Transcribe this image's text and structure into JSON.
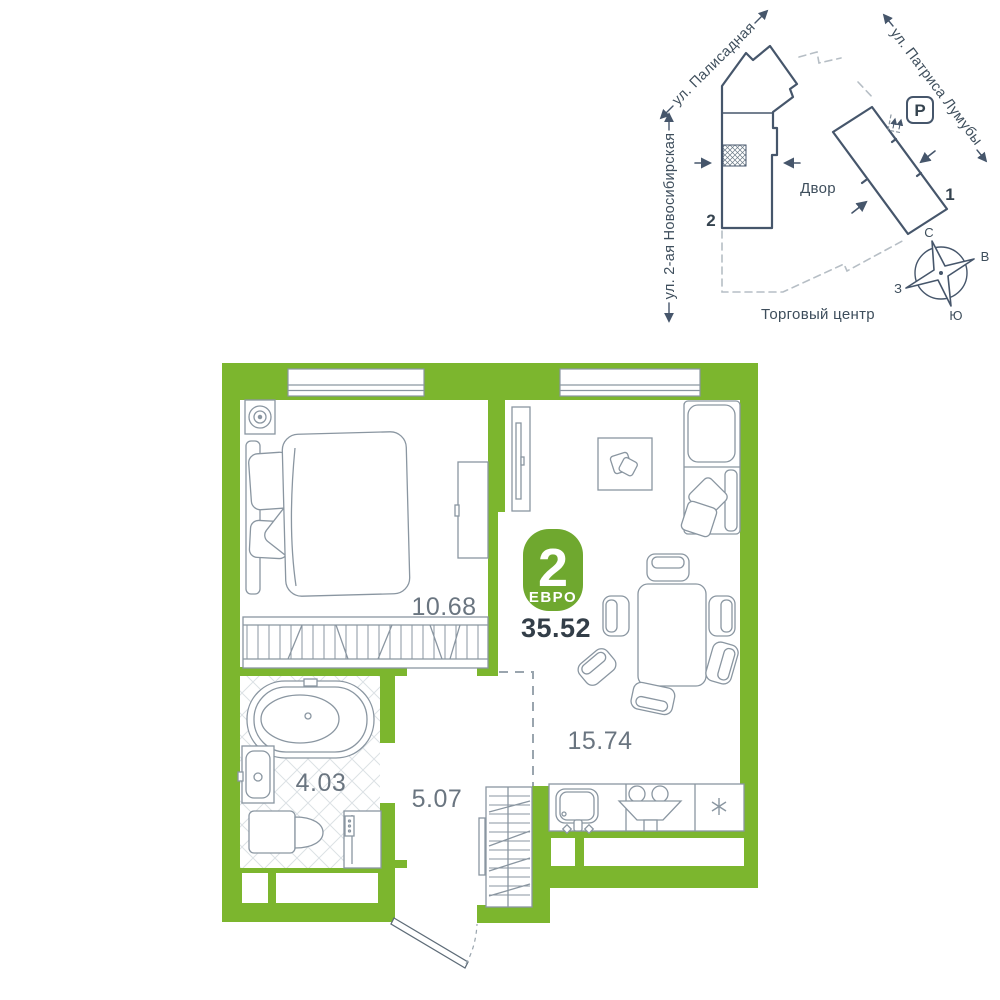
{
  "plan": {
    "badge": {
      "number": "2",
      "type": "ЕВРО"
    },
    "total_area": "35.52",
    "areas": {
      "bedroom": "10.68",
      "living_kitchen": "15.74",
      "bathroom": "4.03",
      "hallway": "5.07"
    }
  },
  "map": {
    "streets": {
      "palisadnaya": "ул. Палисадная",
      "patrisa_lumumby": "ул. Патриса Лумубы",
      "novosibirskaya": "ул. 2-ая Новосибирская"
    },
    "yard_label": "Двор",
    "mall_label": "Торговый центр",
    "parking_label": "P",
    "building_1_label": "1",
    "building_2_label": "2",
    "compass": {
      "north": "С",
      "east": "В",
      "south": "Ю",
      "west": "З"
    }
  },
  "colors": {
    "wall_green": "#7CB62E",
    "badge_green": "#6FA82F",
    "furniture_line": "#84919C",
    "map_line": "#46566B",
    "label_text": "#6A7580",
    "area_text": "#333E48"
  }
}
